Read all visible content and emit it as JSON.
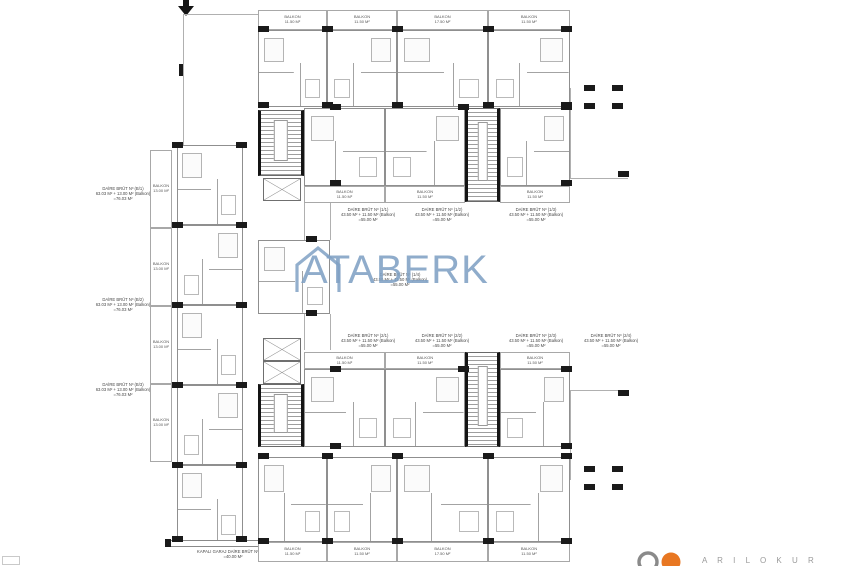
{
  "watermark": {
    "text": "ATABERK",
    "color": "#80a1c4"
  },
  "icons": {
    "entrance_arrow": "down-arrow",
    "watermark_house": "house-outline",
    "logo_marks": "gray-ring-and-orange-disc"
  },
  "balconies": {
    "top": [
      "BALKON\n11.50 M²",
      "BALKON\n11.50 M²",
      "BALKON\n17.50 M²",
      "BALKON\n11.50 M²"
    ],
    "upper_inner": [
      "BALKON\n11.50 M²",
      "BALKON\n11.50 M²",
      "BALKON\n11.50 M²"
    ],
    "lower_inner": [
      "BALKON\n11.50 M²",
      "BALKON\n11.50 M²",
      "BALKON\n11.50 M²"
    ],
    "bottom": [
      "BALKON\n11.50 M²",
      "BALKON\n11.50 M²",
      "BALKON\n17.50 M²",
      "BALKON\n11.50 M²"
    ],
    "left_wing": [
      "BALKON\n13.00 M²",
      "BALKON\n13.00 M²",
      "BALKON\n13.00 M²",
      "BALKON\n13.00 M²"
    ]
  },
  "apartment_labels": {
    "upper_row": [
      "DAİRE BRÜT Nº (1/1)\n43.50 M² + 11.50 M² (Balkon)\n=55.00 M²",
      "DAİRE BRÜT Nº (1/2)\n43.50 M² + 11.50 M² (Balkon)\n=55.00 M²",
      "DAİRE BRÜT Nº (1/3)\n43.50 M² + 11.50 M² (Balkon)\n=55.00 M²"
    ],
    "center": "DAİRE BRÜT Nº (1/4)\n43.50 M² + 11.50 M² (Balkon)\n=55.00 M²",
    "lower_row": [
      "DAİRE BRÜT Nº (2/1)\n43.50 M² + 11.50 M² (Balkon)\n=55.00 M²",
      "DAİRE BRÜT Nº (2/2)\n43.50 M² + 11.50 M² (Balkon)\n=55.00 M²",
      "DAİRE BRÜT Nº (2/3)\n43.50 M² + 11.50 M² (Balkon)\n=55.00 M²",
      "DAİRE BRÜT Nº (2/4)\n43.50 M² + 11.50 M² (Balkon)\n=55.00 M²"
    ],
    "left_wing": [
      "DAİRE BRÜT Nº (B/1)\n63.03 M² + 13.00 M² (Balkon)\n=76.03 M²",
      "DAİRE BRÜT Nº (B/2)\n63.03 M² + 13.00 M² (Balkon)\n=76.03 M²",
      "DAİRE BRÜT Nº (B/3)\n63.03 M² + 13.00 M² (Balkon)\n=76.03 M²"
    ],
    "garage": "KAPALI GARAJ DAİRE BRÜT Nº (A/1)\n=40.00 M²"
  },
  "logo": {
    "letters": "A R I L O K U R",
    "gray": "#8a8a8a",
    "orange": "#e87722"
  }
}
